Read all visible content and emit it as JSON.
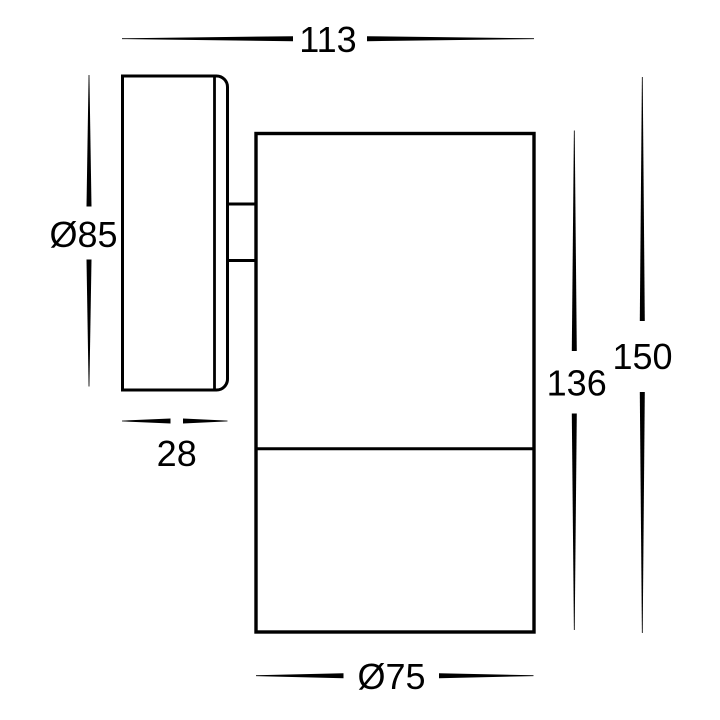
{
  "colors": {
    "background": "#ffffff",
    "line": "#000000",
    "text": "#000000"
  },
  "drawing": {
    "labels": {
      "width_overall": "113",
      "backplate_diameter": "Ø85",
      "backplate_depth": "28",
      "body_length": "136",
      "length_overall": "150",
      "body_diameter": "Ø75"
    }
  }
}
